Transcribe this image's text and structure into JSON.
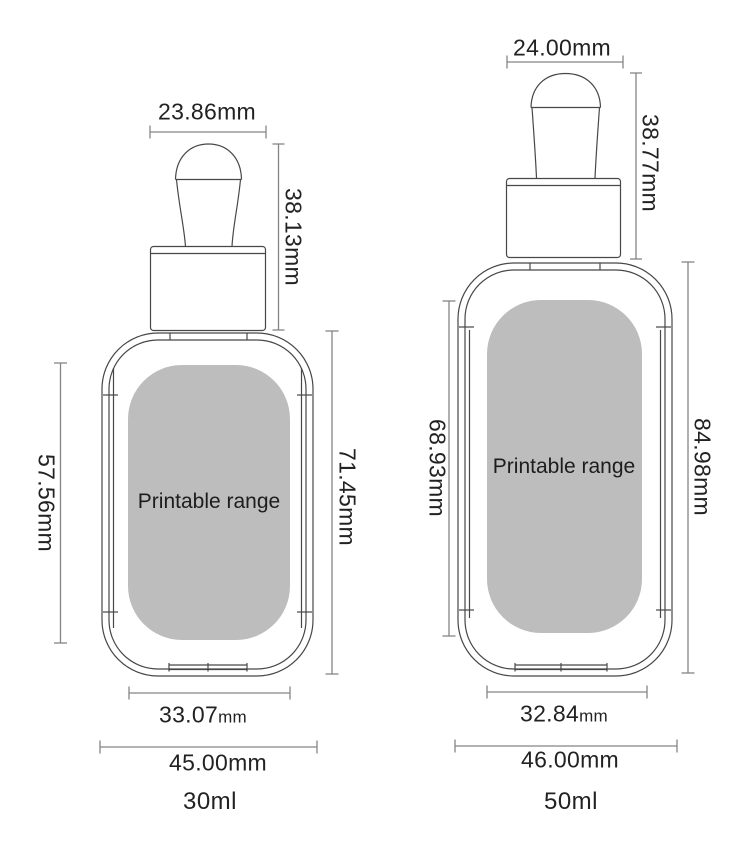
{
  "diagram": {
    "printable_label": "Printable range",
    "bottles": [
      {
        "volume": "30ml",
        "top_width": "23.86mm",
        "dropper_height": "38.13mm",
        "printable_height": "57.56mm",
        "body_height": "71.45mm",
        "printable_width_value": "33.07",
        "printable_width_unit": "mm",
        "base_width": "45.00mm"
      },
      {
        "volume": "50ml",
        "top_width": "24.00mm",
        "dropper_height": "38.77mm",
        "printable_height": "68.93mm",
        "body_height": "84.98mm",
        "printable_width_value": "32.84",
        "printable_width_unit": "mm",
        "base_width": "46.00mm"
      }
    ],
    "colors": {
      "outline": "#474747",
      "dimension_line": "#858585",
      "printable_fill": "#bdbdbd",
      "text": "#222222"
    }
  }
}
